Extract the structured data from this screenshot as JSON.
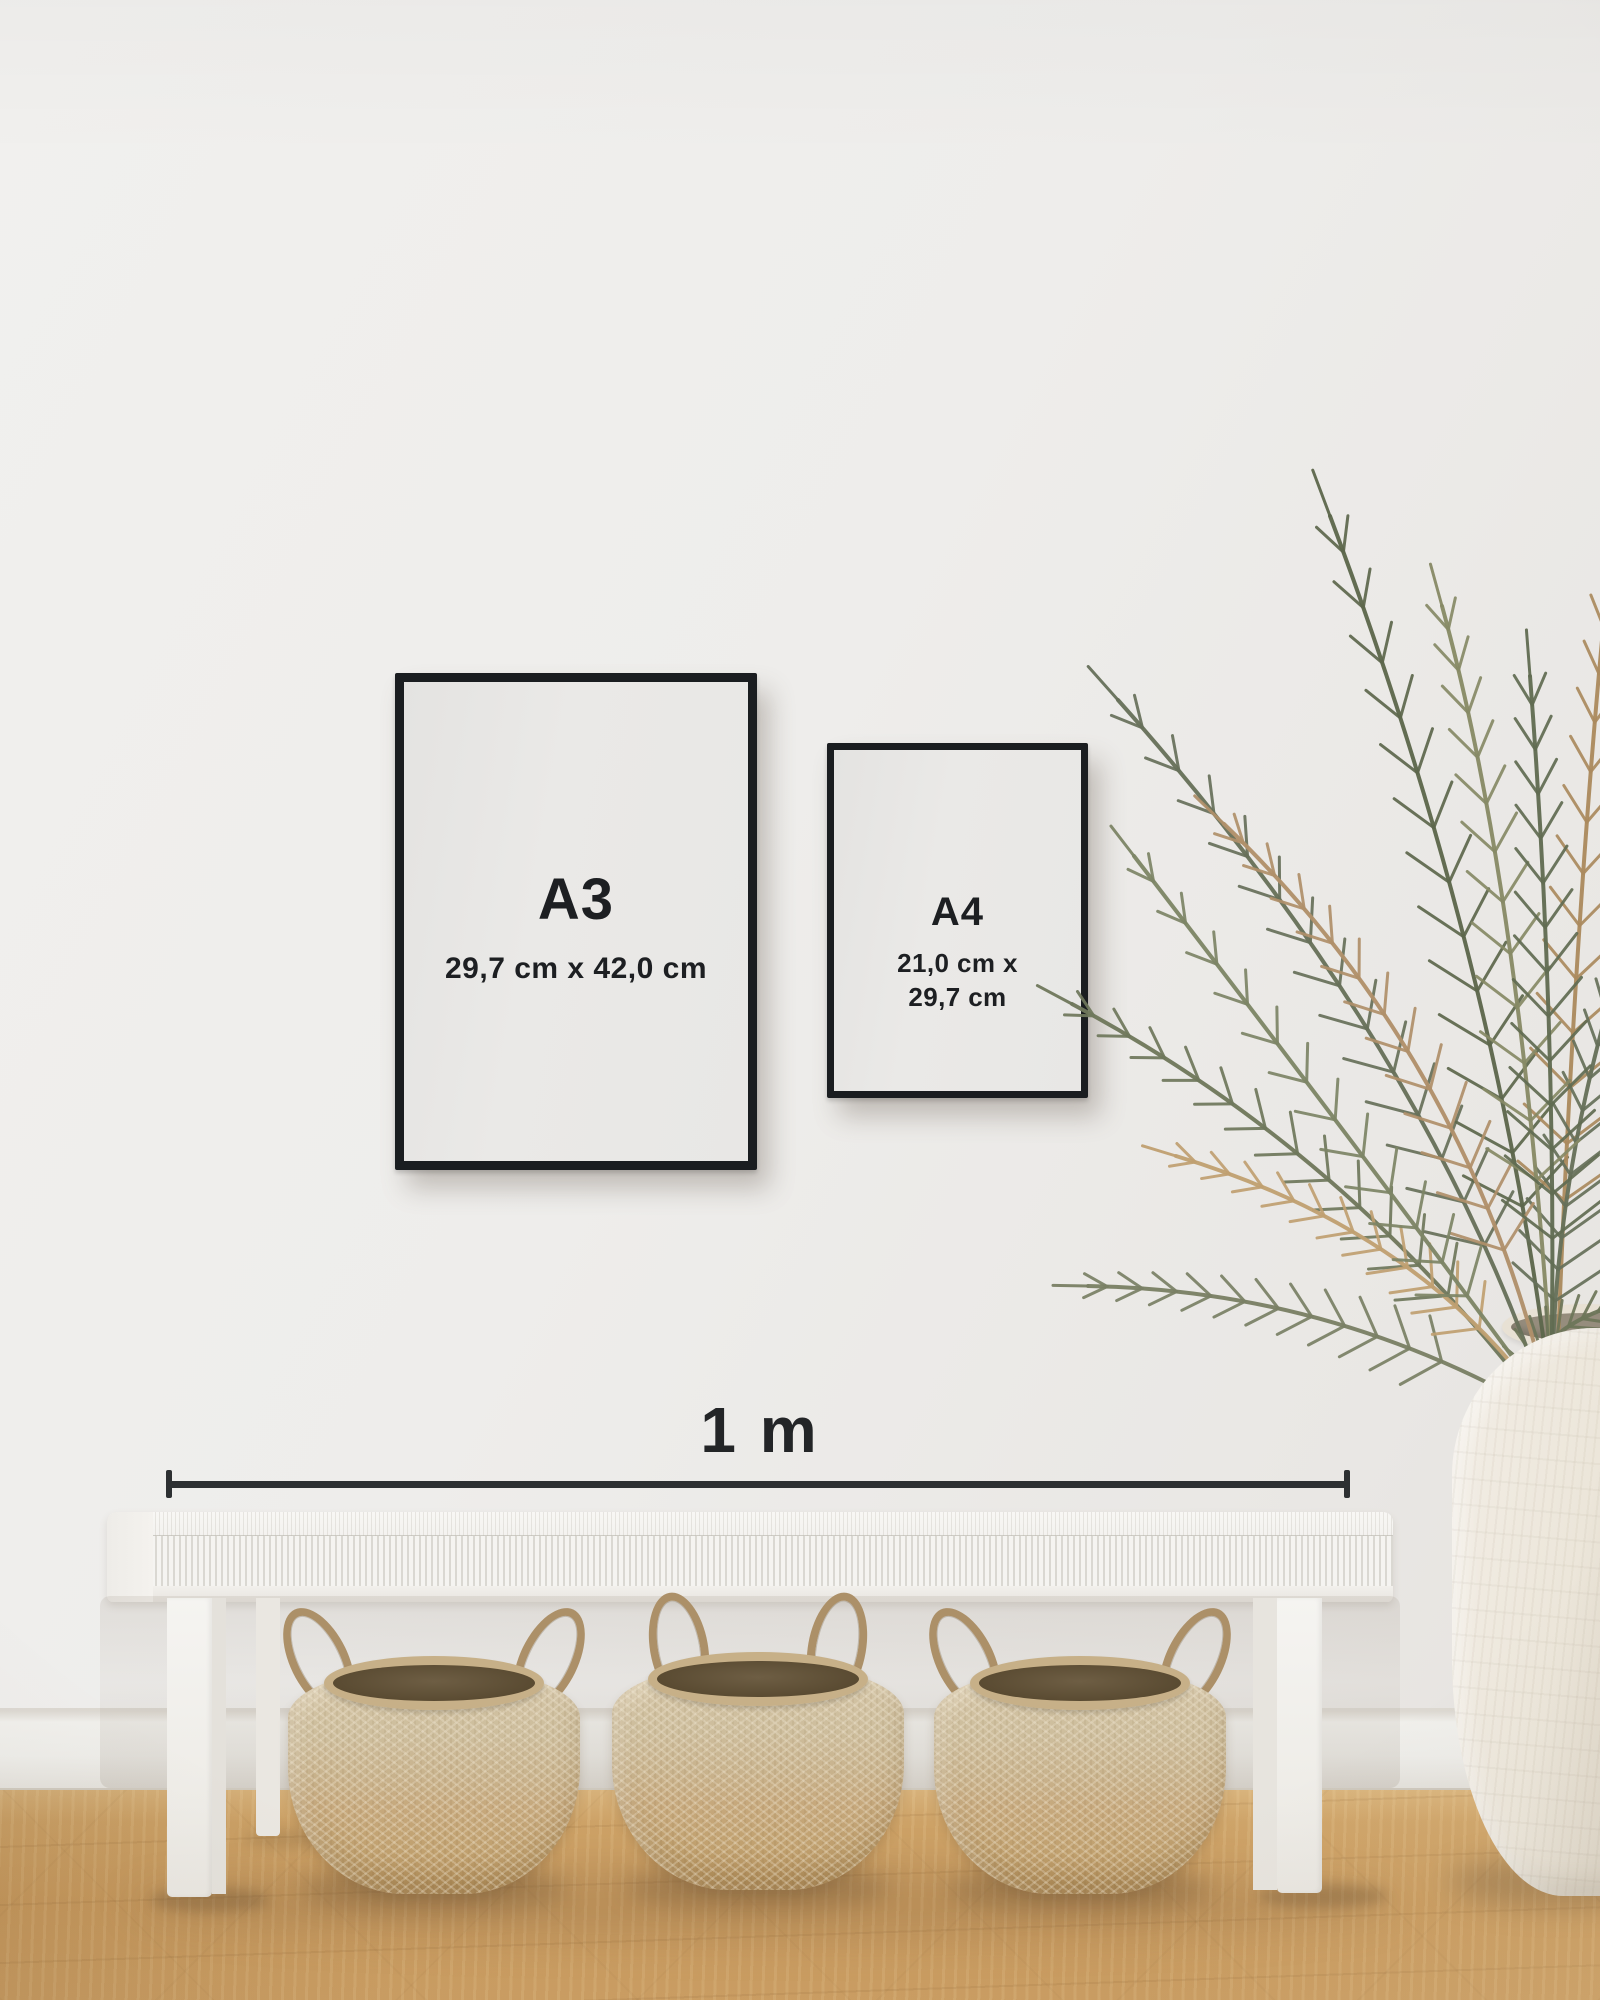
{
  "frames": {
    "a3": {
      "label": "A3",
      "dimensions": "29,7 cm x 42,0 cm"
    },
    "a4": {
      "label": "A4",
      "dimensions_line1": "21,0 cm x",
      "dimensions_line2": "29,7 cm"
    }
  },
  "scale": {
    "label": "1 m"
  },
  "colors": {
    "wall": "#efeeec",
    "baseboard": "#edece8",
    "floor_oak": "#c89a5e",
    "frame": "#1a1d20",
    "poster_paper": "#e9e8e6",
    "text": "#1d1f22",
    "scale_bar": "#2d3032",
    "bench_white": "#f5f4f1",
    "basket_weave": "#c6a87c",
    "basket_interior": "#5a4b32",
    "plant_green": "#67705a",
    "plant_tan": "#ab8a5e",
    "vase_ceramic": "#ece6da"
  }
}
